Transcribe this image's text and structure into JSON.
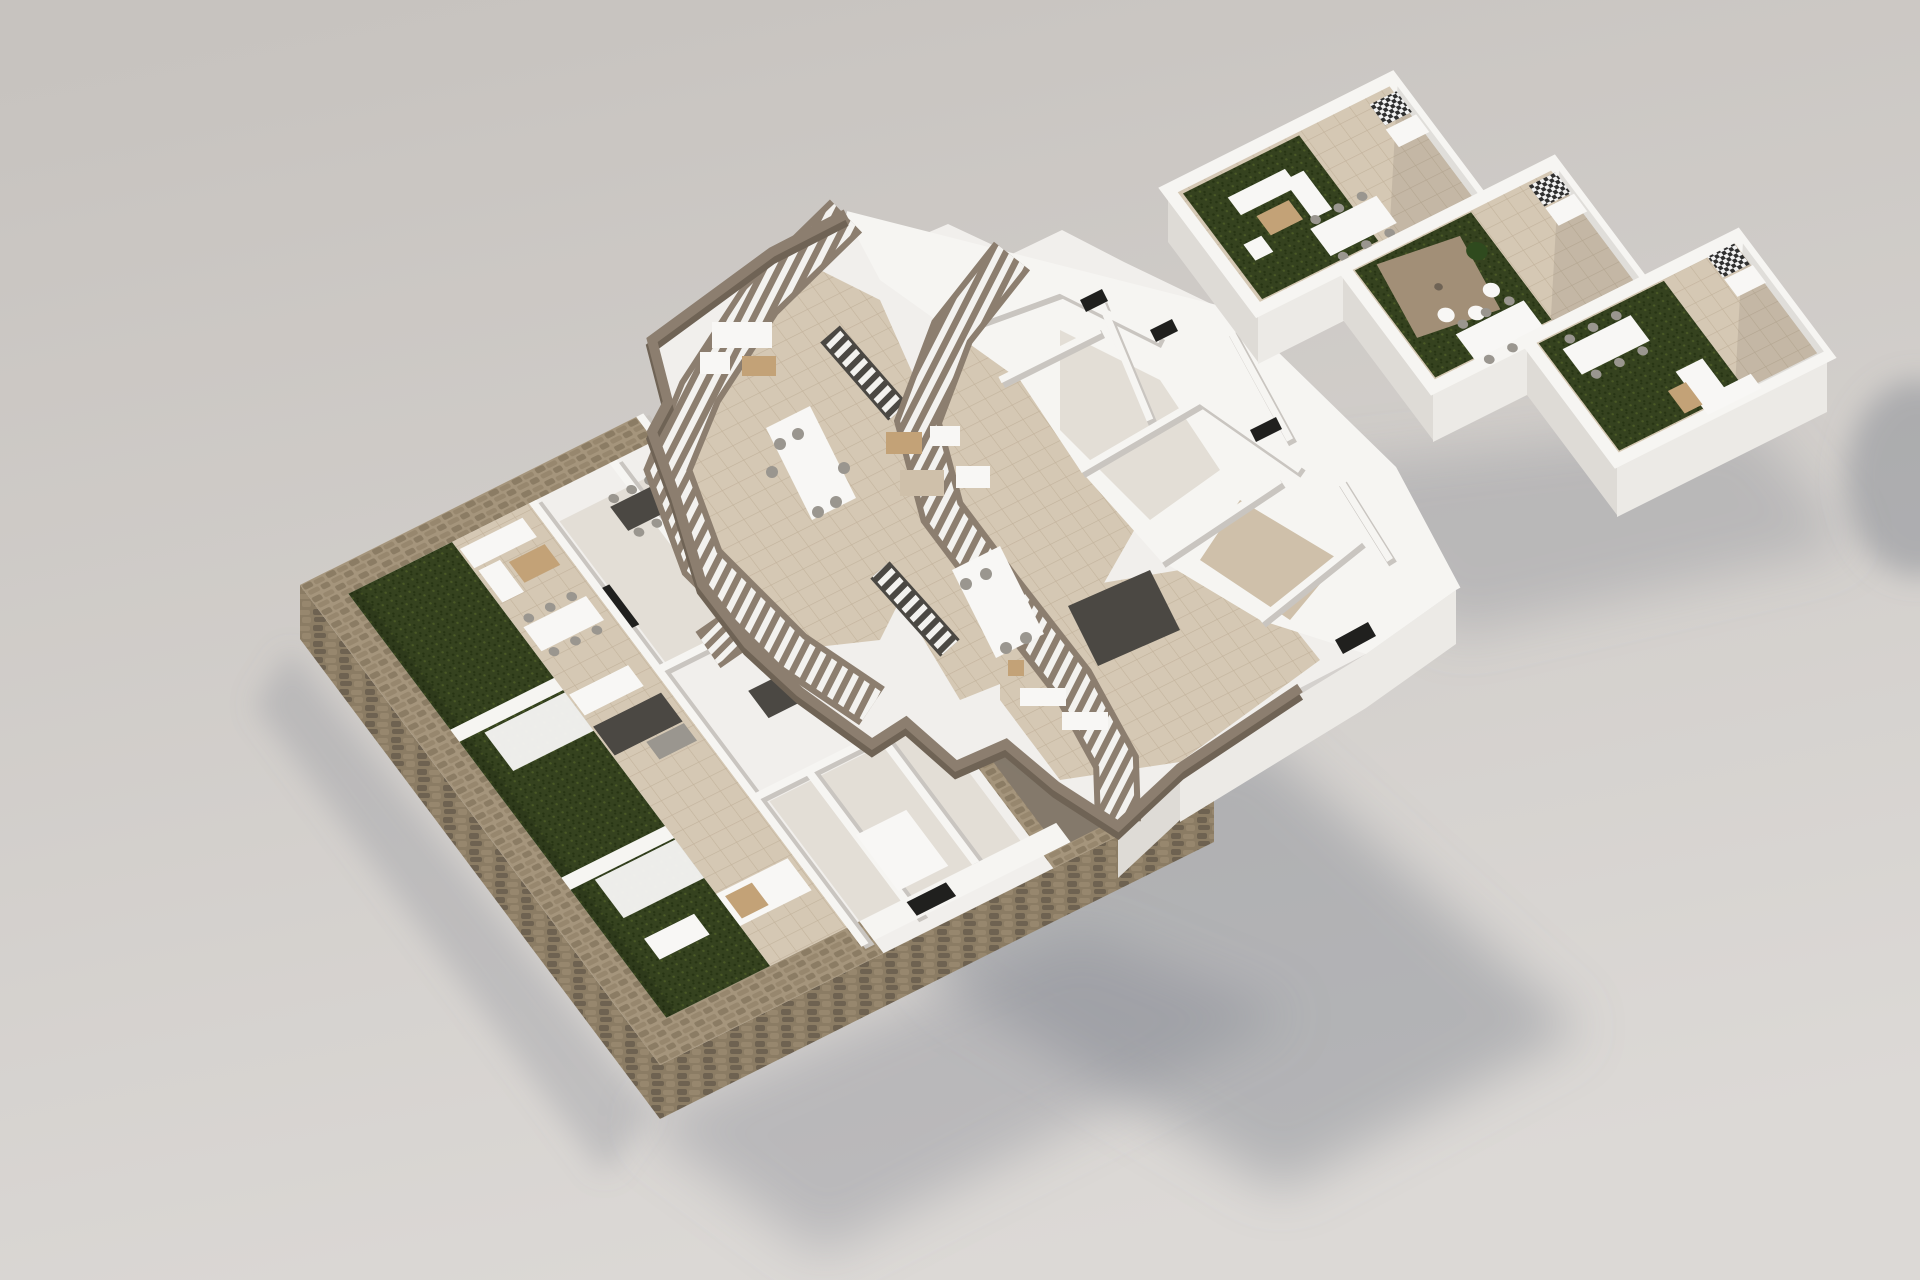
{
  "scene": {
    "type": "3d-architectural-floor-plan-render",
    "view": "axonometric-exploded-three-levels",
    "floors": [
      {
        "id": "ground-floor",
        "position": "bottom-left",
        "features": [
          "stone perimeter retaining wall",
          "three private artificial-turf gardens",
          "white garden dividing walls",
          "pergola dining tables",
          "terrace lounge furniture",
          "apartment interior rooms",
          "front facade window",
          "stone walled court"
        ]
      },
      {
        "id": "middle-floor",
        "position": "center",
        "features": [
          "two exterior zig-zag staircases with taupe parapets",
          "tiled terraces",
          "outdoor lounge and dining furniture",
          "interior stair flights",
          "apartment interior rooms",
          "access staircase to gardens"
        ]
      },
      {
        "id": "roof-terrace-level",
        "position": "top-right",
        "features": [
          "three stepped roof terraces",
          "artificial turf decks",
          "outdoor dining tables",
          "lounge sofa sets",
          "parasol",
          "checker-tiled barbecue planter units",
          "white parapet walls"
        ]
      }
    ],
    "palette": {
      "bg_top": "#c7c3bf",
      "bg_bottom": "#dcd9d6",
      "wall_white": "#f6f5f2",
      "wall_shade": "#dedbd6",
      "wall_dark": "#c9c5c0",
      "slab_face": "#eceae6",
      "room_fill": "#f1efec",
      "floor_int": "#e3ded6",
      "tile": "#d5c8b4",
      "tile_line": "#c3b39c",
      "tile_warm": "#cfc0aa",
      "turf": "#35421f",
      "turf_dark": "#273414",
      "turf_light": "#4a5a26",
      "stone": "#a5957c",
      "stone_dark": "#8b7c64",
      "stone_face": "#97876e",
      "stone_joint": "#6e6251",
      "taupe": "#8c7e6f",
      "taupe_dark": "#6f6355",
      "tread": "#f3f2ef",
      "shadow": "#7f828c",
      "court_floor": "#84796b",
      "furn_white": "#f8f7f5",
      "furn_tan": "#c3a277",
      "furn_dark": "#4b4843",
      "furn_gray": "#9a968f",
      "check_dark": "#2f2f2f",
      "check_light": "#f2f2f2",
      "plant": "#2f4a1e",
      "parasol": "#a28f77",
      "window_dark": "#20201e"
    }
  }
}
